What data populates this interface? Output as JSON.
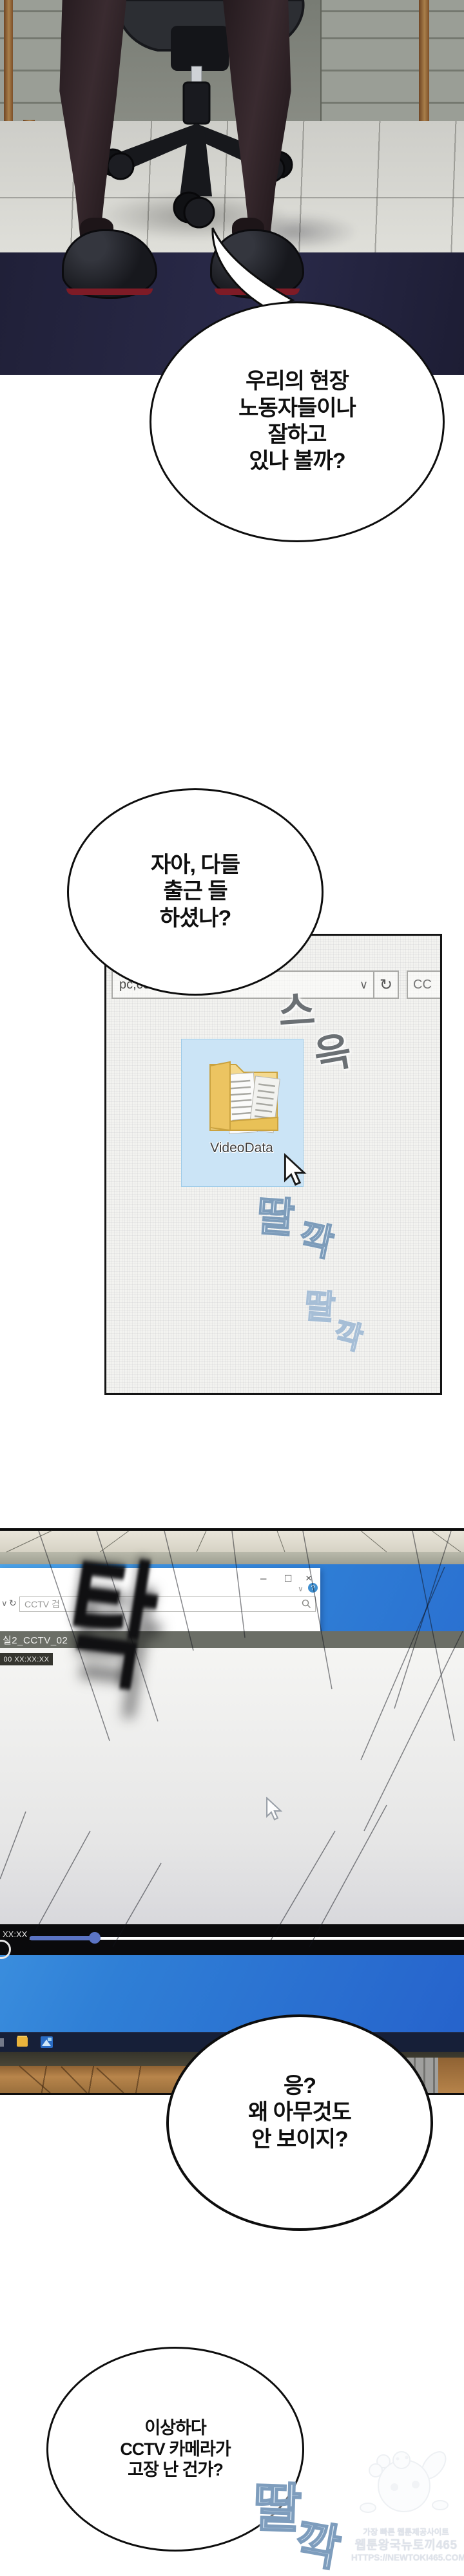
{
  "bubbles": [
    {
      "lines": [
        "우리의 현장",
        "노동자들이나",
        "잘하고",
        "있나 볼까?"
      ]
    },
    {
      "lines": [
        "자아, 다들",
        "출근 들",
        "하셨나?"
      ]
    },
    {
      "lines": [
        "응?",
        "왜 아무것도",
        "안 보이지?"
      ]
    },
    {
      "lines": [
        "이상하다",
        "CCTV 카메라가",
        "고장 난 건가?"
      ]
    }
  ],
  "explorer": {
    "address_text": "pc,ce",
    "address_chevron": "∨",
    "refresh_glyph": "↻",
    "search_text": "CC",
    "folder_label": "VideoData"
  },
  "sfx": {
    "slide": [
      "스",
      "윽"
    ],
    "click_a": [
      "딸",
      "깍"
    ],
    "click_b": [
      "딸",
      "깍"
    ],
    "click_c": [
      "딸",
      "깍"
    ],
    "slam": "탁"
  },
  "screen": {
    "win_min": "–",
    "win_max": "□",
    "win_close": "×",
    "help_chevron": "∨",
    "help_q": "?",
    "addr_chevron": "∨",
    "addr_refresh": "↻",
    "search_text": "CCTV 검",
    "video_title": "실2_CCTV_02",
    "osd_ghost": "0 50 50",
    "osd_badge": "00 XX:XX:XX",
    "elapsed": "XX:XX",
    "progress_fraction": 0.15
  },
  "watermark": {
    "line1": "가장 빠른 웹툰제공사이트",
    "line2": "웹툰왕국뉴토끼465",
    "line3": "HTTPS://NEWTOKI465.COM"
  },
  "colors": {
    "accent_blue_desktop": "#2f7fd6",
    "selection_blue": "#cbe4f6",
    "heel_sole_red": "#7e1b26",
    "player_bar": "#0a0a0c",
    "progress_fill": "#5b74c4"
  }
}
